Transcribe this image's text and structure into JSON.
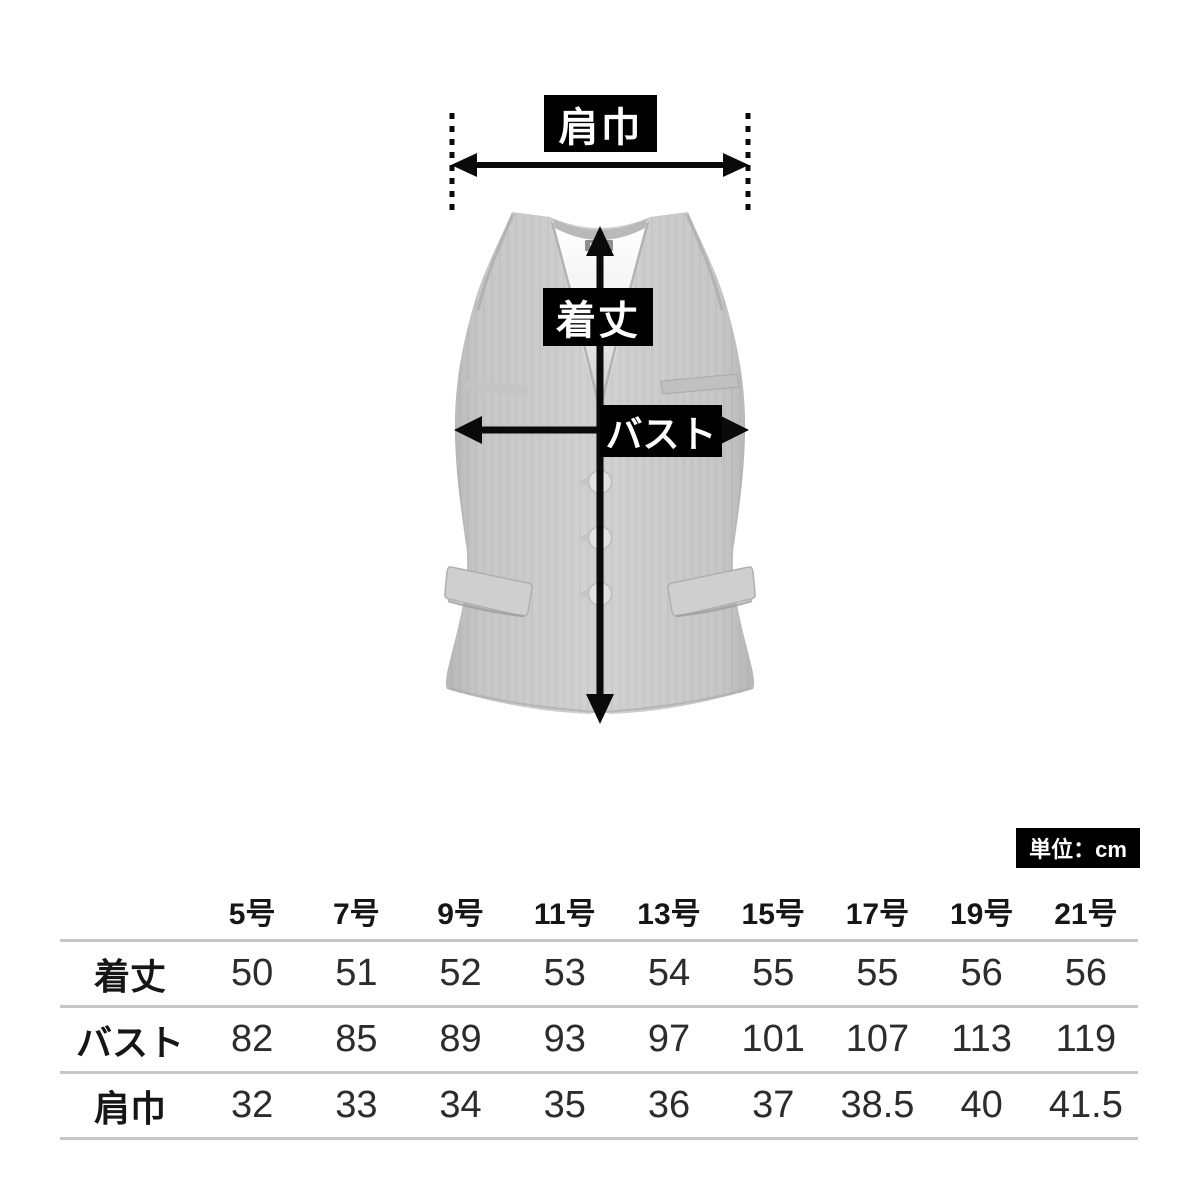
{
  "diagram": {
    "garment": "sleeveless-vest-silhouette",
    "shoulder_width_label": "肩巾",
    "length_label": "着丈",
    "bust_label": "バスト",
    "label_bg_color": "#000000",
    "label_text_color": "#ffffff",
    "arrow_color": "#0a0a0a",
    "vest_color": "#cbcbcb"
  },
  "size_table": {
    "unit_label": "単位：cm",
    "columns": [
      "5号",
      "7号",
      "9号",
      "11号",
      "13号",
      "15号",
      "17号",
      "19号",
      "21号"
    ],
    "rows": [
      {
        "label": "着丈",
        "values": [
          "50",
          "51",
          "52",
          "53",
          "54",
          "55",
          "55",
          "56",
          "56"
        ]
      },
      {
        "label": "バスト",
        "values": [
          "82",
          "85",
          "89",
          "93",
          "97",
          "101",
          "107",
          "113",
          "119"
        ]
      },
      {
        "label": "肩巾",
        "values": [
          "32",
          "33",
          "34",
          "35",
          "36",
          "37",
          "38.5",
          "40",
          "41.5"
        ]
      }
    ],
    "rule_color": "#c7c7c7"
  }
}
